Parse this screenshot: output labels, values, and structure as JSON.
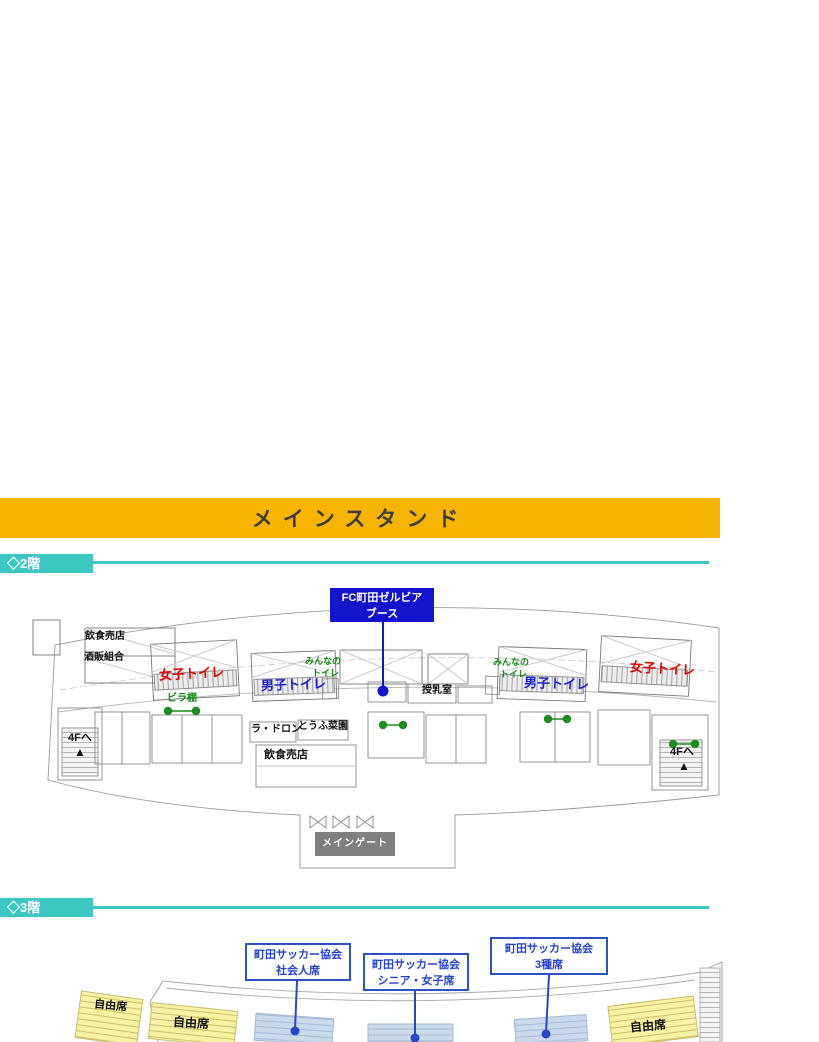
{
  "banner": {
    "title": "メインスタンド"
  },
  "floor2_section": {
    "label": "◇2階"
  },
  "floor3_section": {
    "label": "◇3階"
  },
  "floor2": {
    "booth_line1": "FC町田ゼルビア",
    "booth_line2": "ブース",
    "shop_top": "飲食売店",
    "liquor_union": "酒販組合",
    "womens_toilet_left": "女子トイレ",
    "mens_toilet_left": "男子トイレ",
    "everyone_toilet_left_line1": "みんなの",
    "everyone_toilet_left_line2": "トイレ",
    "nursing_room": "授乳室",
    "everyone_toilet_right_line1": "みんなの",
    "everyone_toilet_right_line2": "トイレ",
    "mens_toilet_right": "男子トイレ",
    "womens_toilet_right": "女子トイレ",
    "flyer_rack": "ビラ棚",
    "to_4f_left": "4Fへ",
    "to_4f_right": "4Fへ",
    "up_arrow": "▲",
    "shop_la_dron": "ラ・ドロン",
    "shop_tofu": "とうふ菜園",
    "shop_bottom": "飲食売店",
    "main_gate": "メインゲート"
  },
  "floor3": {
    "callout_adult_line1": "町田サッカー協会",
    "callout_adult_line2": "社会人席",
    "callout_senior_line1": "町田サッカー協会",
    "callout_senior_line2": "シニア・女子席",
    "callout_u15_line1": "町田サッカー協会",
    "callout_u15_line2": "3種席",
    "free_seat_1": "自由席",
    "free_seat_2": "自由席",
    "free_seat_3": "自由席"
  },
  "colors": {
    "banner_yellow": "#F7B400",
    "section_teal": "#3CC7C0",
    "booth_blue": "#1414CC",
    "callout_blue": "#3050C8",
    "free_seat_yellow": "#F6F1A3",
    "reserved_seat_blue": "#CBDAEB",
    "marker_green": "#1E8C1E",
    "toilet_red": "#E00000",
    "toilet_blue": "#2222CC"
  }
}
